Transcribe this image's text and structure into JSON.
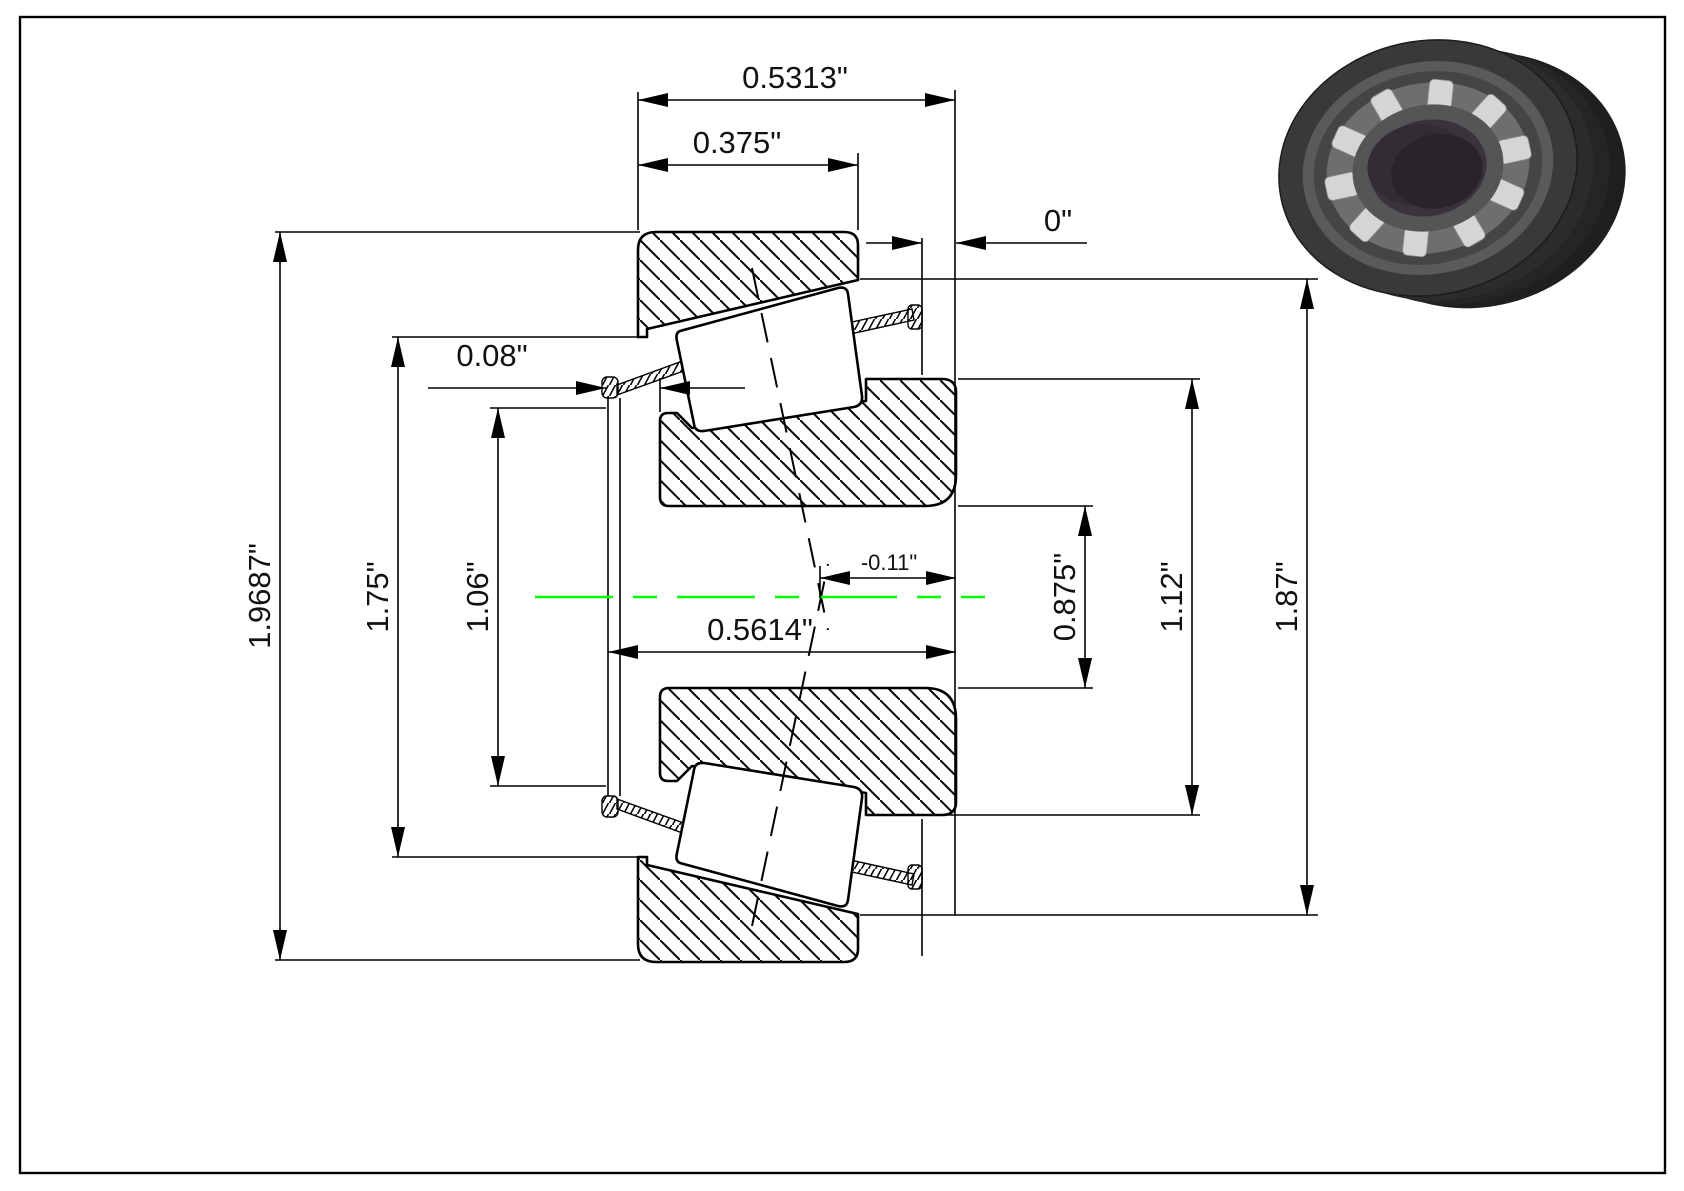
{
  "drawing": {
    "type": "tapered-roller-bearing-cross-section",
    "colors": {
      "line": "#000000",
      "centerline": "#00ff00",
      "background": "#ffffff"
    },
    "dims": {
      "top_outer_width": "0.5313\"",
      "top_inner_width": "0.375\"",
      "right_standout": "0\"",
      "left_standout": "0.08\"",
      "outer_diameter": "1.9687\"",
      "mid_diameter": "1.75\"",
      "inner_rib_diameter": "1.06\"",
      "mid_width": "0.5614\"",
      "effective_center_offset": "-0.11\"",
      "bore_diameter": "0.875\"",
      "cone_front_diameter": "1.12\"",
      "cup_race_diameter": "1.87\""
    }
  },
  "render3d": {
    "colors": {
      "body_dark": "#2b2b2d",
      "ring_face": "#5a5a5c",
      "cage": "#6e6e71",
      "rollers": "#d6d5d3",
      "bore": "#2a242a"
    }
  }
}
